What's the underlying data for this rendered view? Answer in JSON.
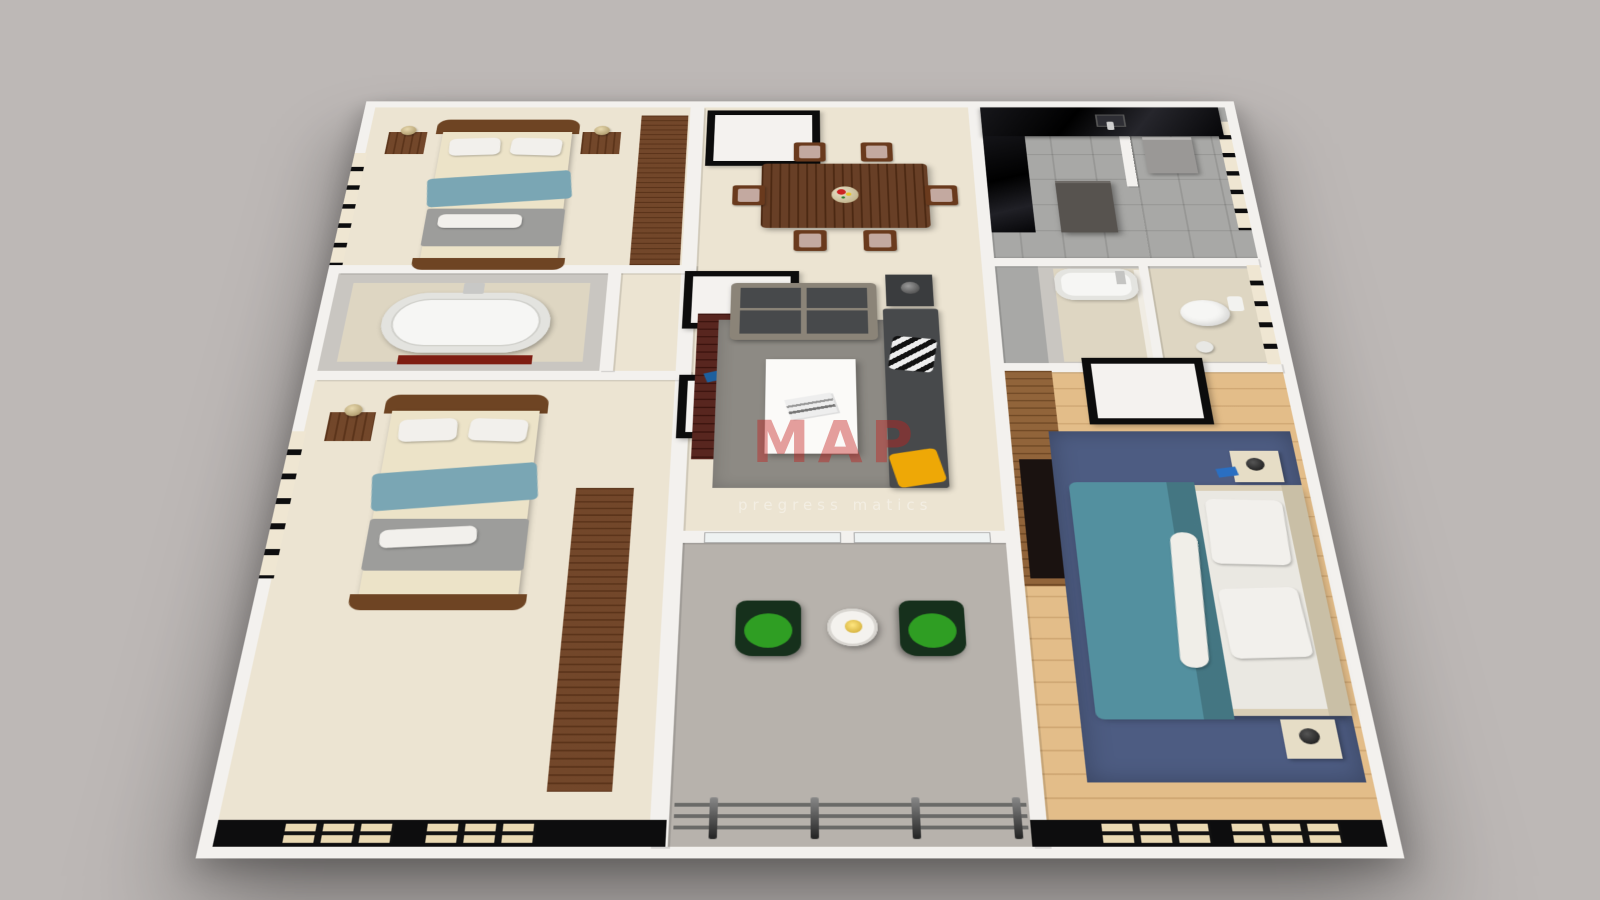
{
  "watermark": {
    "title": "MAP",
    "subtitle": "pregress matics"
  },
  "colors": {
    "bg": "#bdb8b6",
    "wall_white": "#f3f1ee",
    "black": "#0d0d0e",
    "floor_cream": "#ece4d2",
    "floor_wood": "#e3bd89",
    "floor_tile": "#a8a8a6",
    "floor_beige": "#ded6c2",
    "balcony_floor": "#b7b2ac",
    "tile_wall": "#c9c6c1",
    "window_tan": "#ead9b2",
    "wood_dark": "#6b3d1f",
    "wood_mid": "#8a5a2e",
    "wood_red": "#4f1a13",
    "headboard": "#6e4423",
    "table_wood": "#5f3318",
    "chair_wood": "#6a3a1d",
    "chair_cushion": "#c3a9a0",
    "mattress": "#ece3c8",
    "pillow_white": "#f2f0ec",
    "teal": "#7aa6b4",
    "teal_deep": "#53909f",
    "blanket_gray": "#9d9d9b",
    "sofa_frame": "#8b8478",
    "sofa_dark": "#47494b",
    "rug_gray": "#8d8a84",
    "rug_navy": "#4d5c82",
    "green": "#2f9e23",
    "green_dark": "#16301c",
    "yellow": "#eea806",
    "red_mat": "#7e1d12",
    "steel": "#9a9896",
    "tub_white": "#f6f6f4",
    "watermark_red": "rgba(196,32,28,0.42)",
    "watermark_sub": "rgba(255,255,255,0.38)"
  },
  "rooms": [
    {
      "id": "bedroom-1"
    },
    {
      "id": "bathroom-1"
    },
    {
      "id": "bedroom-2"
    },
    {
      "id": "dining-room"
    },
    {
      "id": "living-room"
    },
    {
      "id": "balcony"
    },
    {
      "id": "kitchen"
    },
    {
      "id": "utility-room"
    },
    {
      "id": "bathroom-2"
    },
    {
      "id": "master-bedroom"
    }
  ]
}
